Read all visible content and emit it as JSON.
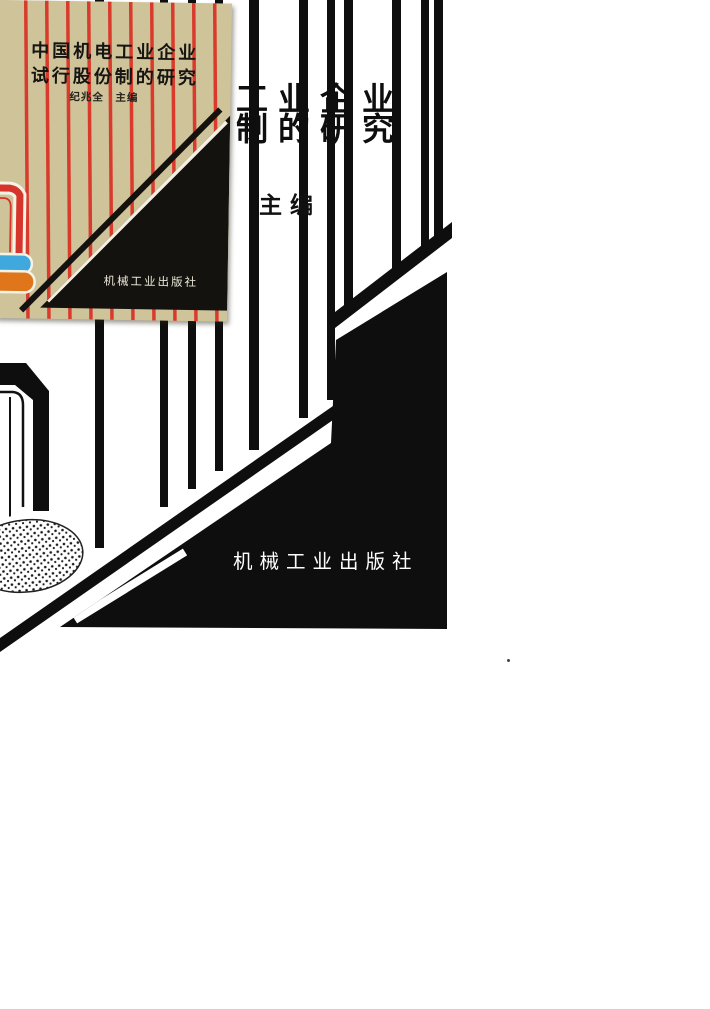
{
  "inset_cover": {
    "title_line1": "中国机电工业企业",
    "title_line2": "试行股份制的研究",
    "author": "纪兆全　主编",
    "publisher": "机械工业出版社",
    "colors": {
      "background": "#cfc39a",
      "stripe_red": "#d93a2b",
      "frame_red": "#d6352b",
      "band_blue": "#3fa8dc",
      "band_orange": "#e0761c",
      "ink_black": "#14120f",
      "publisher_text": "#ece7d8"
    }
  },
  "main_cover": {
    "title_fragment_line1": "工业企业",
    "title_fragment_line2": "制的研究",
    "editor_mark": ":",
    "editor_label": "主编",
    "publisher": "机械工业出版社",
    "colors": {
      "ink": "#0e0e0e",
      "background": "#ffffff",
      "publisher_text": "#ffffff"
    }
  }
}
